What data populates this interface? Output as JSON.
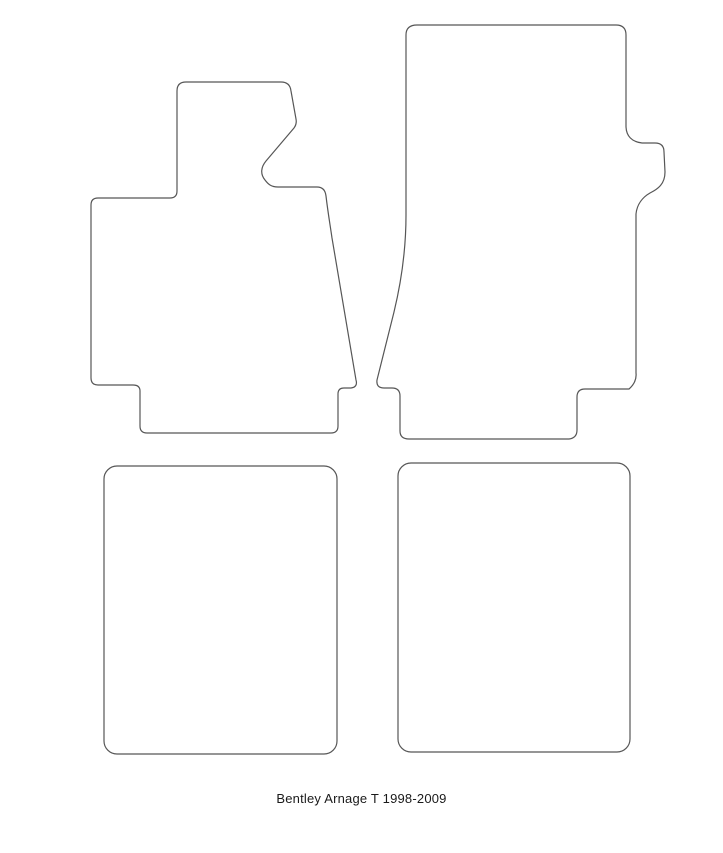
{
  "page": {
    "background": "#ffffff",
    "outline_color": "#565656"
  },
  "caption": {
    "text": "Bentley Arnage T 1998-2009"
  },
  "diagram": {
    "kind": "car-floor-mat-set-outline-template",
    "pieces": [
      {
        "name": "front-left-mat",
        "shape": "irregular-with-footrest-tongue"
      },
      {
        "name": "front-right-mat",
        "shape": "irregular-with-side-notch"
      },
      {
        "name": "rear-left-mat",
        "shape": "rounded-rectangle"
      },
      {
        "name": "rear-right-mat",
        "shape": "rounded-rectangle"
      }
    ]
  }
}
